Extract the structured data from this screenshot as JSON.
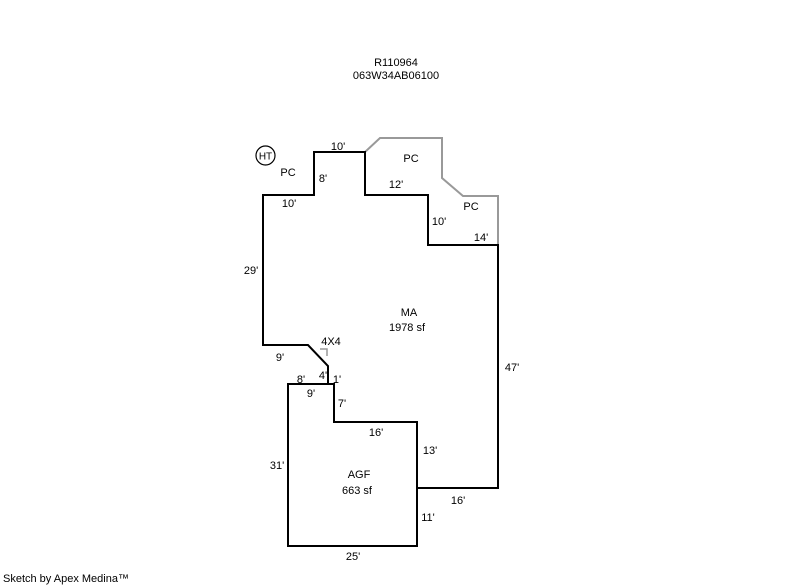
{
  "header": {
    "sketch_id": "R110964",
    "parcel_number": "063W34AB06100"
  },
  "areas": {
    "main": {
      "code": "MA",
      "size": "1978 sf"
    },
    "garage": {
      "code": "AGF",
      "size": "663 sf"
    }
  },
  "markers": {
    "heater": "HT",
    "porch_top_left": "PC",
    "porch_upper": "PC",
    "porch_right": "PC",
    "corner_note": "4X4"
  },
  "dimensions": {
    "top_10": "10'",
    "step_8": "8'",
    "upper_left_10": "10'",
    "upper_12": "12'",
    "right_step_10": "10'",
    "right_14": "14'",
    "left_29": "29'",
    "right_47": "47'",
    "notch_9": "9'",
    "notch_4": "4'",
    "notch_1": "1'",
    "garage_top_8": "8'",
    "garage_top_9": "9'",
    "garage_7": "7'",
    "garage_16": "16'",
    "shared_13": "13'",
    "garage_left_31": "31'",
    "bottom_16": "16'",
    "garage_right_11": "11'",
    "garage_bottom_25": "25'"
  },
  "footer": {
    "credit": "Sketch by Apex Medina™"
  },
  "colors": {
    "building_outline": "#000000",
    "porch_outline": "#999999",
    "background": "#ffffff"
  }
}
